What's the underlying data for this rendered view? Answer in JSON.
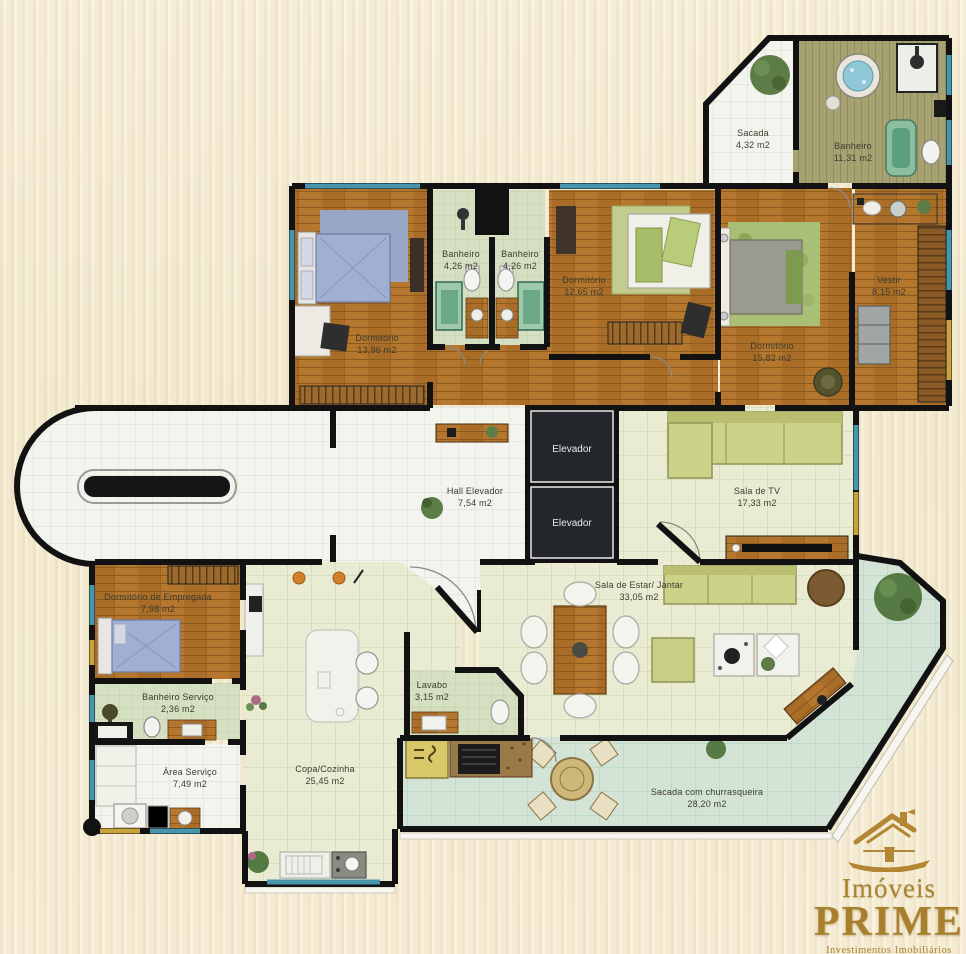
{
  "title": "Planta do apartamento",
  "colors": {
    "background": "#f3ecd5",
    "wall": "#121212",
    "wood_floor": "#b5772e",
    "white_tile": "#f3f4ee",
    "living_tile": "#e9ecd3",
    "balcony_tile": "#d3e4d6",
    "bath_tile": "#d5dfc1",
    "window_glass": "#4795ad",
    "logo_gold": "#ab8232"
  },
  "rooms": [
    {
      "name": "Sacada",
      "area": "4,32 m2"
    },
    {
      "name": "Banheiro",
      "area": "11,31 m2"
    },
    {
      "name": "Dormitório",
      "area": "13,96 m2"
    },
    {
      "name": "Banheiro",
      "area": "4,26 m2"
    },
    {
      "name": "Banheiro",
      "area": "4,26 m2"
    },
    {
      "name": "Dormitório",
      "area": "12,65 m2"
    },
    {
      "name": "Dormitório",
      "area": "15,82 m2"
    },
    {
      "name": "Vestir",
      "area": "8,15 m2"
    },
    {
      "name": "Hall Elevador",
      "area": "7,54 m2"
    },
    {
      "name": "Sala de TV",
      "area": "17,33 m2"
    },
    {
      "name": "Sala de Estar/ Jantar",
      "area": "33,05 m2"
    },
    {
      "name": "Dormitório de Empregada",
      "area": "7,98 m2"
    },
    {
      "name": "Banheiro Serviço",
      "area": "2,36 m2"
    },
    {
      "name": "Área Serviço",
      "area": "7,49 m2"
    },
    {
      "name": "Copa/Cozinha",
      "area": "25,45 m2"
    },
    {
      "name": "Lavabo",
      "area": "3,15 m2"
    },
    {
      "name": "Sacada com churrasqueira",
      "area": "28,20 m2"
    }
  ],
  "elevators": {
    "label": "Elevador"
  },
  "logo": {
    "line1": "Imóveis",
    "line2": "PRIME",
    "line3": "Investimentos Imobiliários"
  }
}
